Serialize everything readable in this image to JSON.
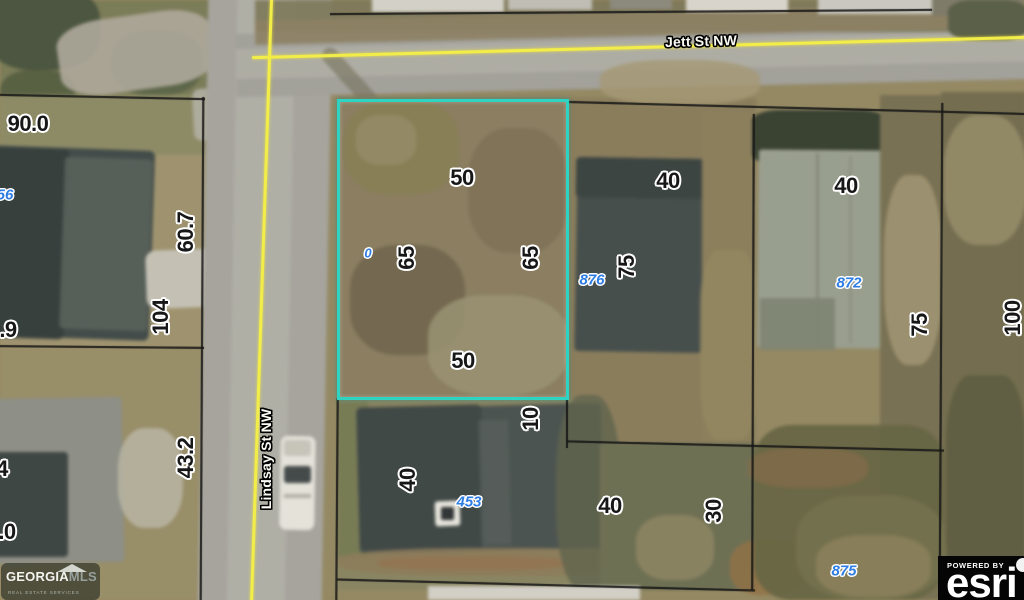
{
  "map": {
    "labels": [
      {
        "text": "Jett St NW",
        "x": 701,
        "y": 41,
        "rot": -1.5,
        "kind": "street",
        "name": "street-label-jett"
      },
      {
        "text": "Lindsay St NW",
        "x": 266,
        "y": 459,
        "rot": -90,
        "kind": "street",
        "name": "street-label-lindsay"
      },
      {
        "text": "90.0",
        "x": 28,
        "y": 124,
        "rot": 0,
        "kind": "dim",
        "name": "dim-90-0"
      },
      {
        "text": "56",
        "x": 5,
        "y": 195,
        "rot": 0,
        "kind": "pid",
        "name": "parcel-id-56"
      },
      {
        "text": "60.7",
        "x": 186,
        "y": 232,
        "rot": -90,
        "kind": "dim",
        "name": "dim-60-7"
      },
      {
        "text": "104",
        "x": 161,
        "y": 317,
        "rot": -90,
        "kind": "dim",
        "name": "dim-104"
      },
      {
        "text": ".9",
        "x": 8,
        "y": 330,
        "rot": 0,
        "kind": "dim",
        "name": "dim-dot-9"
      },
      {
        "text": "43.2",
        "x": 186,
        "y": 458,
        "rot": -90,
        "kind": "dim",
        "name": "dim-43-2"
      },
      {
        "text": "4",
        "x": 2,
        "y": 469,
        "rot": 0,
        "kind": "dim",
        "name": "dim-4"
      },
      {
        "text": ".0",
        "x": 7,
        "y": 532,
        "rot": 0,
        "kind": "dim",
        "name": "dim-dot-0"
      },
      {
        "text": "50",
        "x": 462,
        "y": 178,
        "rot": 0,
        "kind": "dim",
        "name": "dim-50-top"
      },
      {
        "text": "0",
        "x": 368,
        "y": 253,
        "rot": 0,
        "size": 13,
        "kind": "pid",
        "name": "parcel-id-0"
      },
      {
        "text": "65",
        "x": 407,
        "y": 258,
        "rot": -90,
        "kind": "dim",
        "name": "dim-65-left"
      },
      {
        "text": "65",
        "x": 531,
        "y": 258,
        "rot": -90,
        "kind": "dim",
        "name": "dim-65-right"
      },
      {
        "text": "50",
        "x": 463,
        "y": 361,
        "rot": 0,
        "kind": "dim",
        "name": "dim-50-bottom"
      },
      {
        "text": "10",
        "x": 531,
        "y": 419,
        "rot": -90,
        "kind": "dim",
        "name": "dim-10"
      },
      {
        "text": "40",
        "x": 668,
        "y": 181,
        "rot": 0,
        "kind": "dim",
        "name": "dim-40-876"
      },
      {
        "text": "75",
        "x": 627,
        "y": 267,
        "rot": -90,
        "kind": "dim",
        "name": "dim-75-876"
      },
      {
        "text": "876",
        "x": 592,
        "y": 280,
        "rot": 0,
        "kind": "pid",
        "name": "parcel-id-876"
      },
      {
        "text": "40",
        "x": 846,
        "y": 186,
        "rot": 0,
        "kind": "dim",
        "name": "dim-40-872"
      },
      {
        "text": "872",
        "x": 849,
        "y": 283,
        "rot": 0,
        "kind": "pid",
        "name": "parcel-id-872"
      },
      {
        "text": "75",
        "x": 920,
        "y": 325,
        "rot": -90,
        "kind": "dim",
        "name": "dim-75-right"
      },
      {
        "text": "100",
        "x": 1013,
        "y": 318,
        "rot": -90,
        "kind": "dim",
        "name": "dim-100"
      },
      {
        "text": "40",
        "x": 408,
        "y": 480,
        "rot": -90,
        "kind": "dim",
        "name": "dim-40-453"
      },
      {
        "text": "453",
        "x": 469,
        "y": 502,
        "rot": 0,
        "kind": "pid",
        "name": "parcel-id-453"
      },
      {
        "text": "40",
        "x": 610,
        "y": 506,
        "rot": 0,
        "kind": "dim",
        "name": "dim-40-mid"
      },
      {
        "text": "30",
        "x": 714,
        "y": 511,
        "rot": -90,
        "kind": "dim",
        "name": "dim-30"
      },
      {
        "text": "875",
        "x": 844,
        "y": 571,
        "rot": 0,
        "kind": "pid",
        "name": "parcel-id-875"
      }
    ],
    "colors": {
      "highlight_outline": "#2fd3c2",
      "street_line": "#f2ed49",
      "parcel_id_text": "#2e7de5",
      "dimension_text": "#171717"
    },
    "watermarks": {
      "georgiamls": {
        "brand_a": "GEORGIA",
        "brand_b": "MLS",
        "tagline": "REAL ESTATE SERVICES"
      },
      "esri": {
        "powered_by": "POWERED BY",
        "brand": "esri"
      }
    }
  }
}
